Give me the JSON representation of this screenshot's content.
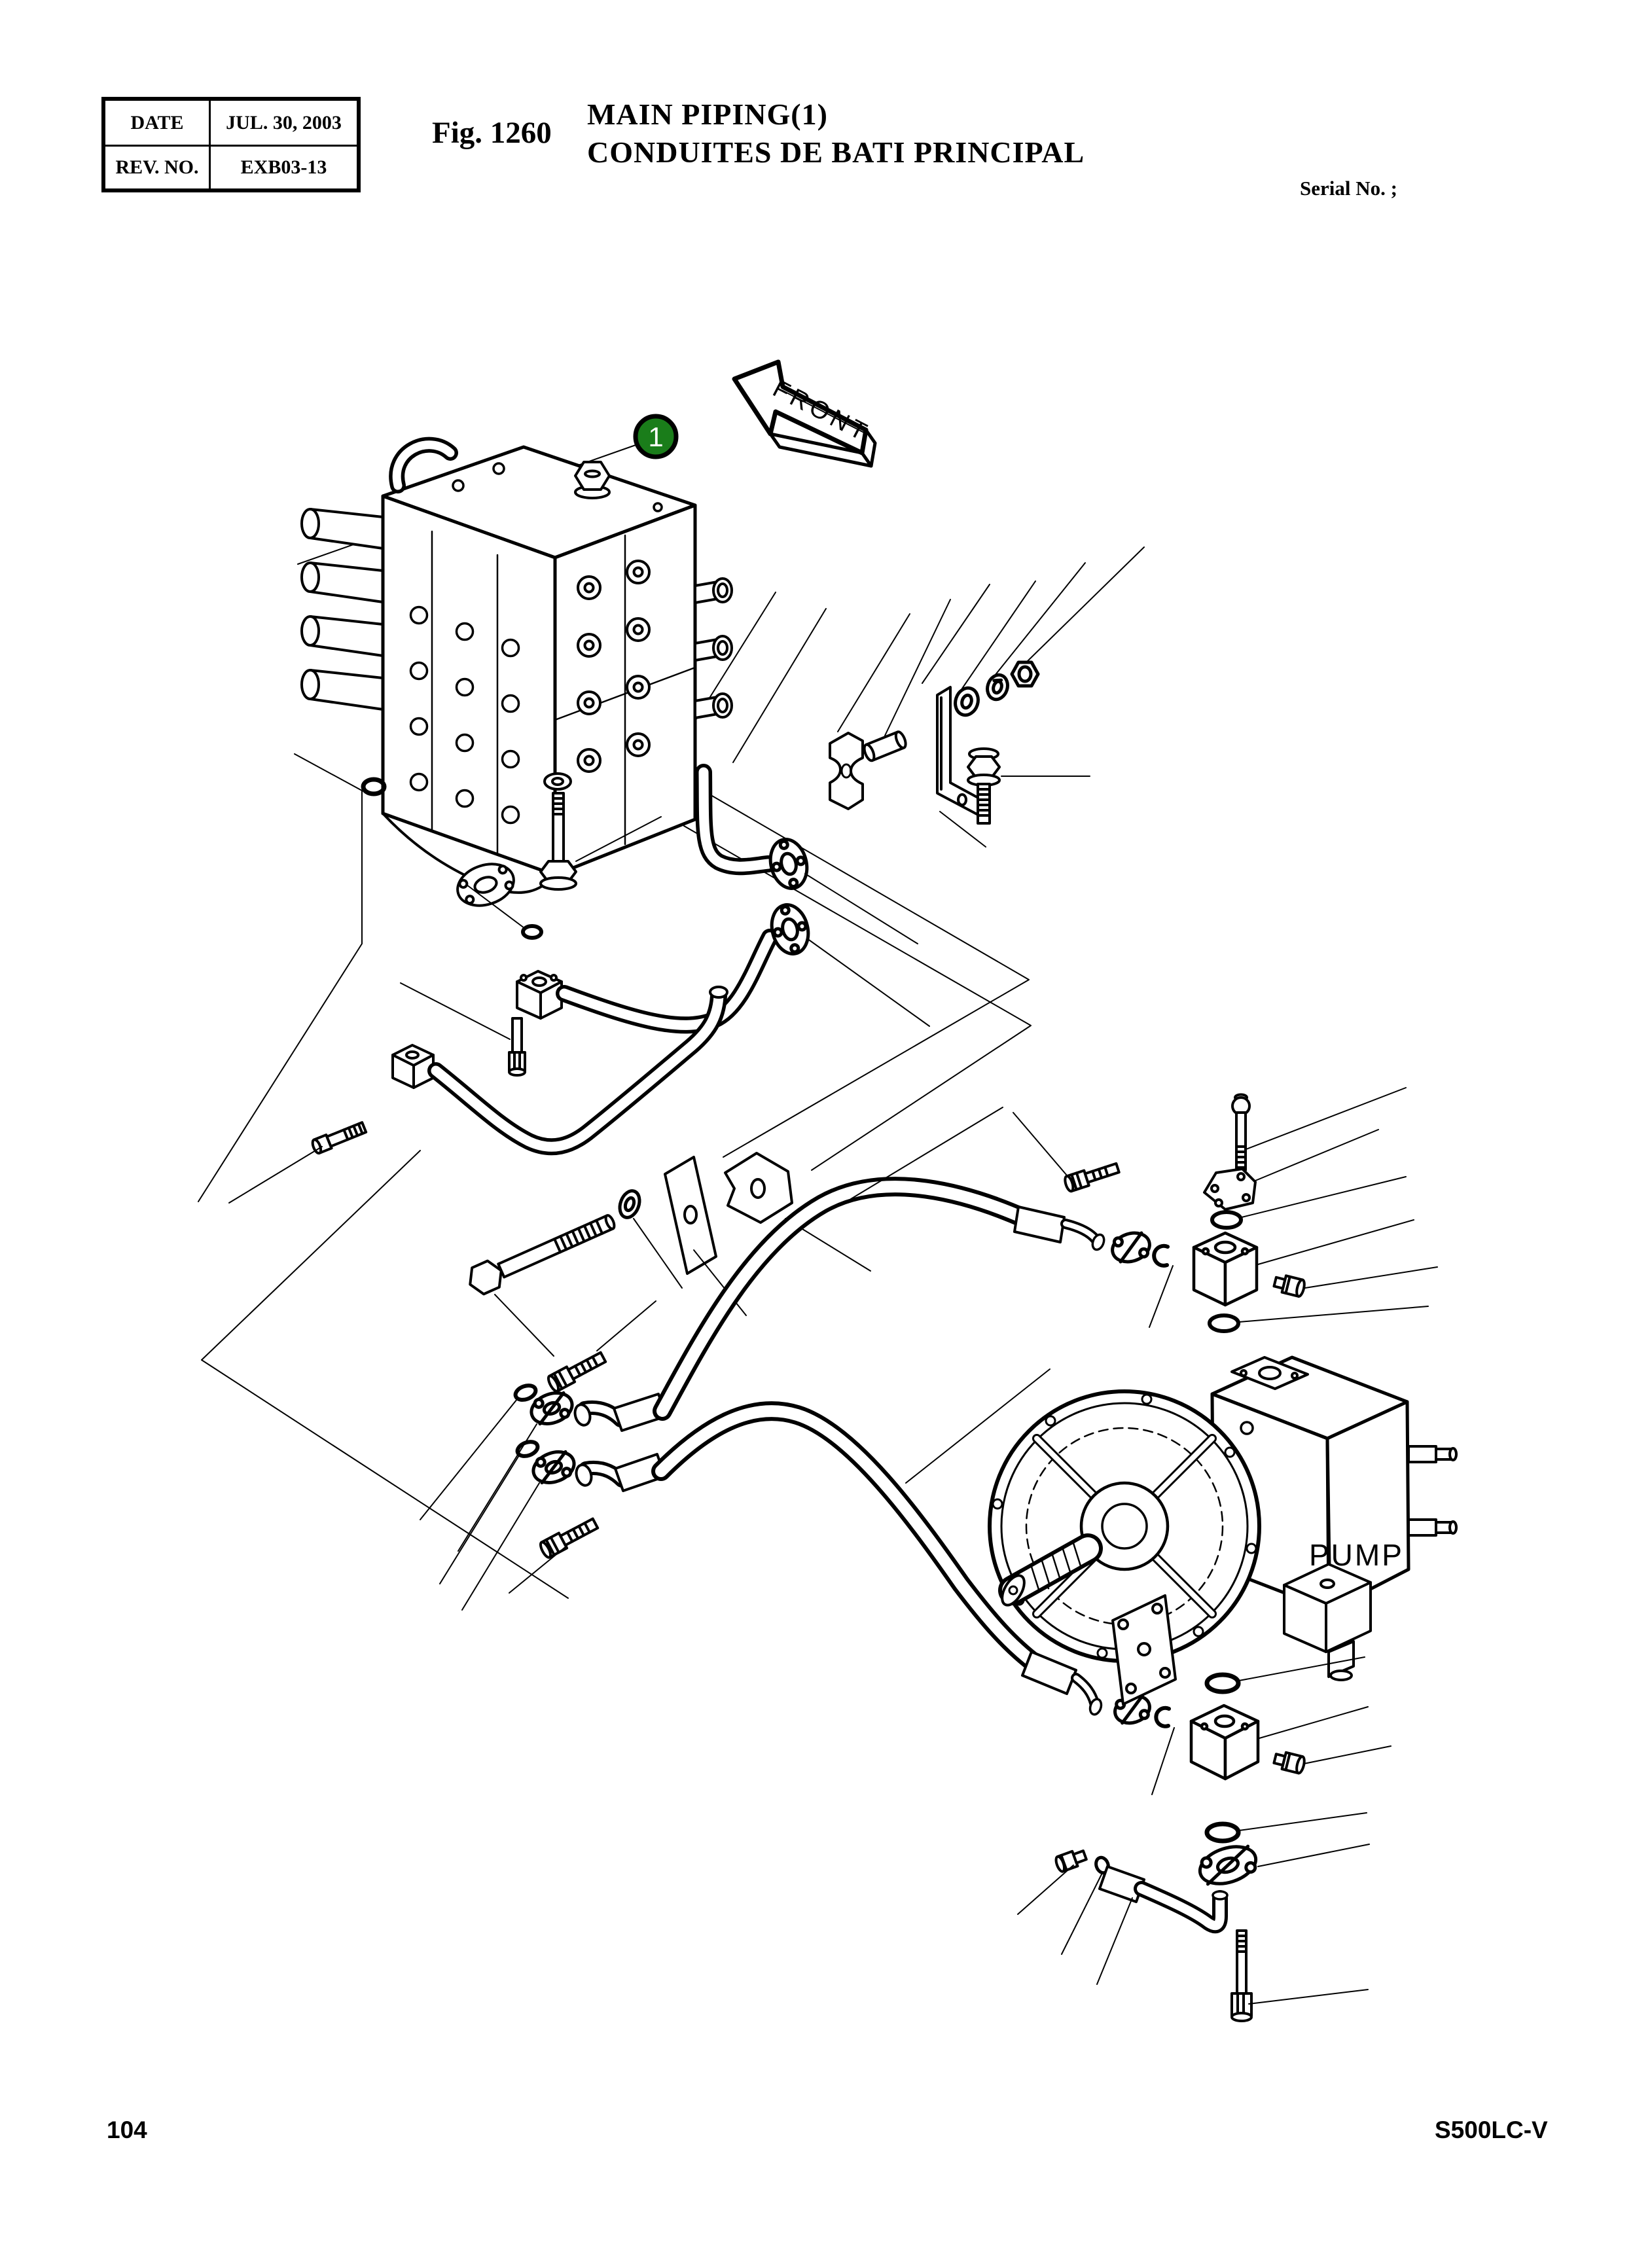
{
  "header": {
    "info_table": {
      "rows": [
        {
          "label": "DATE",
          "value": "JUL. 30, 2003"
        },
        {
          "label": "REV. NO.",
          "value": "EXB03-13"
        }
      ]
    },
    "figure_label": "Fig. 1260",
    "title_line1": "MAIN PIPING(1)",
    "title_line2": "CONDUITES DE BATI PRINCIPAL",
    "serial_label": "Serial No. ;"
  },
  "diagram": {
    "callout_1": "1",
    "front_label": "FRONT",
    "pump_label": "PUMP",
    "colors": {
      "callout_fill": "#1a7d1a",
      "line": "#000000",
      "paper": "#ffffff"
    }
  },
  "footer": {
    "page_number": "104",
    "model_code": "S500LC-V"
  }
}
